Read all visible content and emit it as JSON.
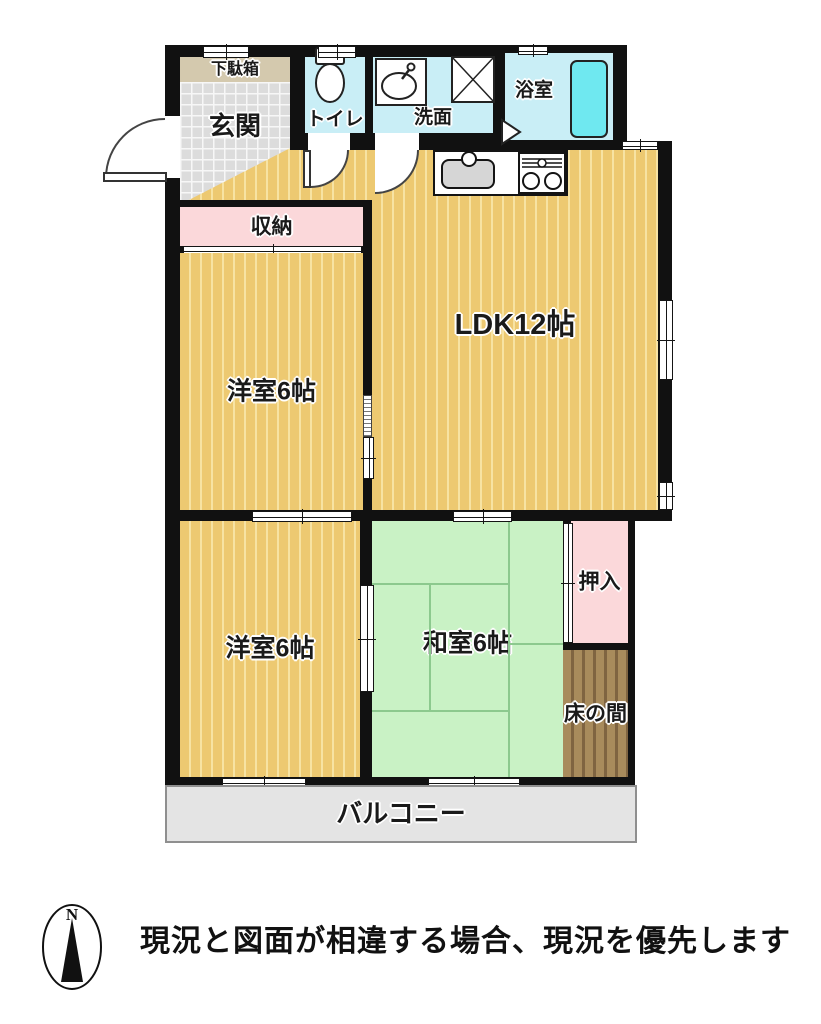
{
  "floorplan": {
    "rooms": {
      "shoe_cabinet": {
        "label": "下駄箱"
      },
      "entrance": {
        "label": "玄関"
      },
      "toilet": {
        "label": "トイレ"
      },
      "washroom": {
        "label": "洗面"
      },
      "bathroom": {
        "label": "浴室"
      },
      "ldk": {
        "label": "LDK12帖"
      },
      "storage": {
        "label": "収納"
      },
      "western_room_upper": {
        "label": "洋室6帖"
      },
      "western_room_lower": {
        "label": "洋室6帖"
      },
      "japanese_room": {
        "label": "和室6帖"
      },
      "closet": {
        "label": "押入"
      },
      "tokonoma": {
        "label": "床の間"
      },
      "balcony": {
        "label": "バルコニー"
      }
    },
    "compass": {
      "north": "N"
    },
    "note": "現況と図面が相違する場合、現況を優先します"
  },
  "colors": {
    "wood": "#edc971",
    "wood_stripe": "#f7e3a3",
    "tile": "#dcdcdc",
    "shoe_cabinet": "#d4c9ae",
    "water": "#c9eef6",
    "bathtub": "#6fe8f0",
    "pink": "#fbd8da",
    "tatami": "#c9f2c5",
    "tatami_line": "#8cc98e",
    "tokonoma": "#a88b5c",
    "tokonoma_stripe": "#7f6441",
    "balcony": "#e4e4e4",
    "wall": "#111111"
  }
}
